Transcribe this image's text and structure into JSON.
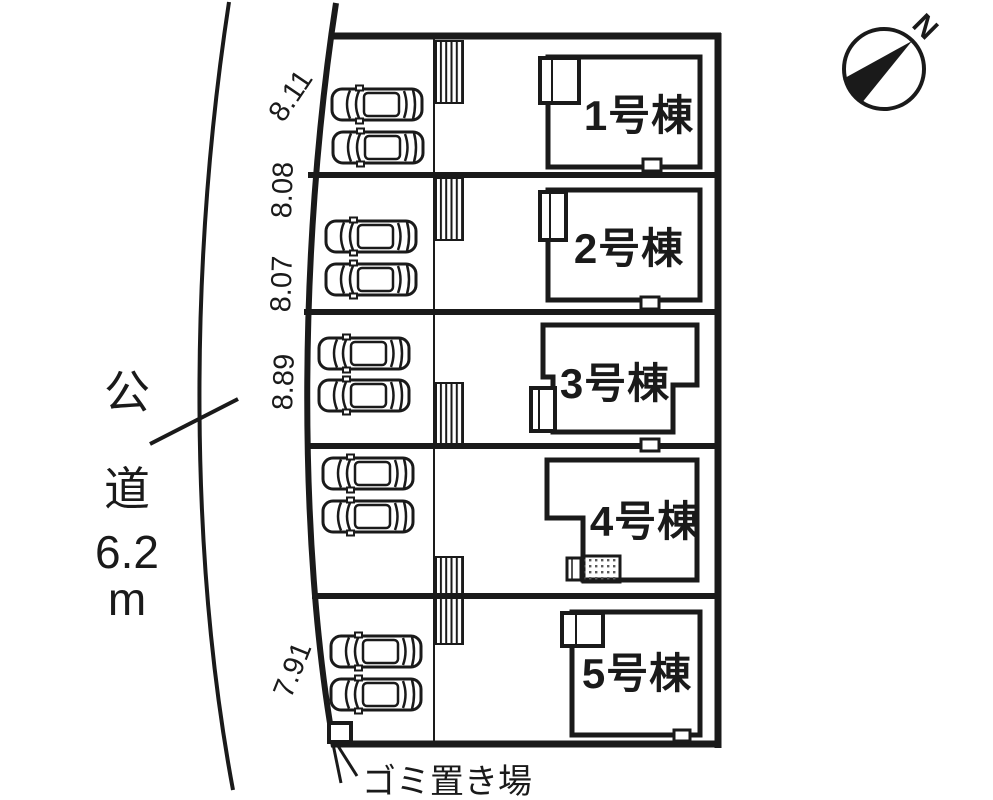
{
  "colors": {
    "ink": "#1a1a1a",
    "paper": "#ffffff"
  },
  "compass": {
    "north_label": "N"
  },
  "road": {
    "label": "公道",
    "width": "6.2m",
    "label_chars": [
      "公",
      "道",
      "6.2",
      "m"
    ]
  },
  "lots": [
    {
      "id": 1,
      "building_label": "1号棟",
      "frontage": "8.11",
      "parking_spaces": 2
    },
    {
      "id": 2,
      "building_label": "2号棟",
      "frontage": "8.08",
      "parking_spaces": 2
    },
    {
      "id": 3,
      "building_label": "3号棟",
      "frontage": "8.07",
      "parking_spaces": 2
    },
    {
      "id": 4,
      "building_label": "4号棟",
      "frontage": "8.89",
      "parking_spaces": 2
    },
    {
      "id": 5,
      "building_label": "5号棟",
      "frontage": "7.91",
      "parking_spaces": 2
    }
  ],
  "garbage_area": {
    "label": "ゴミ置き場"
  },
  "icons": {
    "car": "car-top-view-icon",
    "compass": "north-arrow-icon",
    "hatch": "steps-hatch-icon"
  }
}
